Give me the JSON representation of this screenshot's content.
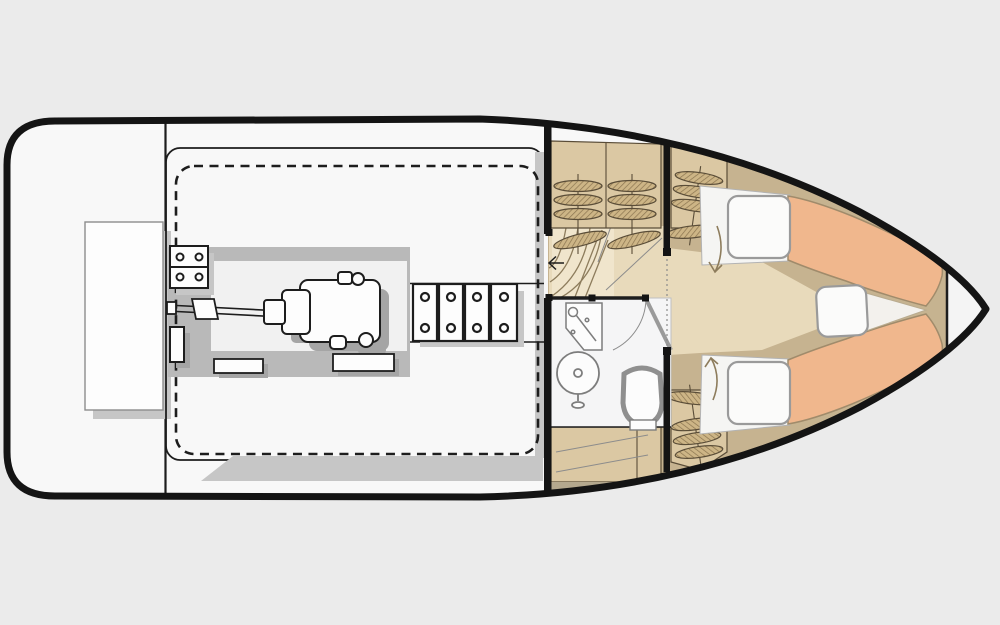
{
  "canvas": {
    "width": 1000,
    "height": 625
  },
  "figure": {
    "kind": "boat floor plan, overhead view",
    "text_labels": [],
    "components": [
      "hull-outline",
      "transom-bench",
      "cockpit-liner",
      "cockpit-hatch-dashed-outline",
      "engine-bed",
      "engine",
      "propeller-shaft",
      "engine-mount-bracket",
      "engine-hatch-steps",
      "main-bulkhead",
      "companionway-steps",
      "companionway-arrow-icon",
      "port-louver-lockers",
      "starboard-louver-locker-forward",
      "starboard-louver-locker-aft",
      "head-compartment",
      "sink",
      "washbasin",
      "toilet",
      "head-door",
      "aft-cabinets",
      "cabin-floor",
      "v-berth-port",
      "v-berth-starboard",
      "berth-hatch-cushions",
      "bow-filler-cushion",
      "berth-access-arrow-down-icon",
      "berth-access-arrow-up-icon",
      "bow-bulkhead",
      "bow-locker"
    ]
  },
  "colors": {
    "background": "#ebebeb",
    "hull-fill": "#f8f8f8",
    "hull-stroke": "#141414",
    "line-dark": "#1d1d1d",
    "line-gray": "#8c8c8c",
    "shadow-gray": "#c6c6c6",
    "engine-bed-gray": "#b9b9b9",
    "engine-shadow": "#a5a5a5",
    "cabin-tan-base": "#c6b390",
    "panel-tan": "#dbc8a3",
    "slat-fill": "#cdb586",
    "slat-stroke": "#5a4d38",
    "slat-hatch": "#8a7450",
    "floor-beige": "#e8dabb",
    "steps-beige": "#f0e5cc",
    "berth-salmon": "#f0b78d",
    "berth-stroke": "#a08b6b",
    "white-soft": "#f5f5f3",
    "cushion-stroke": "#9a9a9a",
    "arrow-brown": "#8d7c5c",
    "fixture-stroke": "#7d7d7d"
  }
}
